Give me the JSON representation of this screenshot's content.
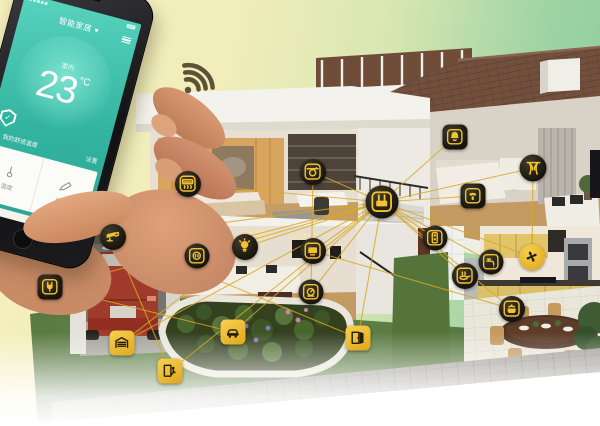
{
  "colors": {
    "accent": "#F2C230",
    "network_line": "#D9A81F",
    "screen_teal": "#35B7A3"
  },
  "phone": {
    "title": "智能家居",
    "caret": "▾",
    "room_label": "室内",
    "temp_value": "23",
    "temp_unit": "°C",
    "shield_check": "✓",
    "comfort_label": "我的舒适温度",
    "settings_label": "设置",
    "card_temp_label": "温度",
    "card_edit_label": "编辑",
    "card2_text": "A"
  },
  "icons": [
    {
      "id": "gateway-hub",
      "glyph": "hub",
      "style": "dark-circle",
      "x": 382,
      "y": 202,
      "size": 33
    },
    {
      "id": "security-camera",
      "glyph": "camera",
      "style": "dark-circle",
      "x": 113,
      "y": 237,
      "size": 26
    },
    {
      "id": "smart-plug",
      "glyph": "plug",
      "style": "dark-square",
      "x": 50,
      "y": 287,
      "size": 25
    },
    {
      "id": "wall-socket",
      "glyph": "socket",
      "style": "dark-circle",
      "x": 197,
      "y": 256,
      "size": 25
    },
    {
      "id": "light-bulb",
      "glyph": "bulb",
      "style": "dark-circle",
      "x": 245,
      "y": 247,
      "size": 26
    },
    {
      "id": "smart-tv",
      "glyph": "tv",
      "style": "dark-circle",
      "x": 313,
      "y": 251,
      "size": 26
    },
    {
      "id": "energy-meter",
      "glyph": "meter",
      "style": "dark-circle",
      "x": 311,
      "y": 292,
      "size": 25
    },
    {
      "id": "garage-door",
      "glyph": "garage",
      "style": "solid-square",
      "x": 122,
      "y": 343,
      "size": 25
    },
    {
      "id": "door-access",
      "glyph": "dooraccess",
      "style": "solid-square",
      "x": 170,
      "y": 371,
      "size": 25
    },
    {
      "id": "smart-car",
      "glyph": "car",
      "style": "solid-square",
      "x": 233,
      "y": 332,
      "size": 25
    },
    {
      "id": "door-sensor",
      "glyph": "doorsensor",
      "style": "solid-square",
      "x": 358,
      "y": 338,
      "size": 25
    },
    {
      "id": "air-conditioner",
      "glyph": "ac",
      "style": "dark-circle",
      "x": 188,
      "y": 184,
      "size": 26
    },
    {
      "id": "washing-machine",
      "glyph": "washer",
      "style": "dark-circle",
      "x": 313,
      "y": 172,
      "size": 26
    },
    {
      "id": "alarm-bell",
      "glyph": "bell",
      "style": "dark-square",
      "x": 455,
      "y": 137,
      "size": 25
    },
    {
      "id": "smart-curtain",
      "glyph": "curtain",
      "style": "dark-circle",
      "x": 533,
      "y": 168,
      "size": 27
    },
    {
      "id": "intercom",
      "glyph": "intercom",
      "style": "dark-square",
      "x": 473,
      "y": 196,
      "size": 25
    },
    {
      "id": "light-switch",
      "glyph": "switch",
      "style": "dark-circle",
      "x": 435,
      "y": 238,
      "size": 25
    },
    {
      "id": "water-faucet",
      "glyph": "faucet",
      "style": "dark-circle",
      "x": 491,
      "y": 262,
      "size": 25
    },
    {
      "id": "exhaust-fan",
      "glyph": "fan",
      "style": "solid-circle",
      "x": 532,
      "y": 257,
      "size": 26
    },
    {
      "id": "cooktop",
      "glyph": "pan",
      "style": "dark-circle",
      "x": 465,
      "y": 276,
      "size": 26
    },
    {
      "id": "rice-cooker",
      "glyph": "pot",
      "style": "dark-circle",
      "x": 512,
      "y": 309,
      "size": 26
    }
  ],
  "connections": [
    [
      "gateway-hub",
      "security-camera"
    ],
    [
      "gateway-hub",
      "smart-plug"
    ],
    [
      "gateway-hub",
      "wall-socket"
    ],
    [
      "gateway-hub",
      "light-bulb"
    ],
    [
      "gateway-hub",
      "smart-tv"
    ],
    [
      "gateway-hub",
      "energy-meter"
    ],
    [
      "gateway-hub",
      "garage-door"
    ],
    [
      "gateway-hub",
      "door-access"
    ],
    [
      "gateway-hub",
      "smart-car"
    ],
    [
      "gateway-hub",
      "door-sensor"
    ],
    [
      "gateway-hub",
      "air-conditioner"
    ],
    [
      "gateway-hub",
      "washing-machine"
    ],
    [
      "gateway-hub",
      "alarm-bell"
    ],
    [
      "gateway-hub",
      "smart-curtain"
    ],
    [
      "gateway-hub",
      "intercom"
    ],
    [
      "gateway-hub",
      "light-switch"
    ],
    [
      "gateway-hub",
      "water-faucet"
    ],
    [
      "gateway-hub",
      "exhaust-fan"
    ],
    [
      "gateway-hub",
      "cooktop"
    ],
    [
      "gateway-hub",
      "rice-cooker"
    ],
    [
      "security-camera",
      "door-sensor"
    ],
    [
      "smart-plug",
      "smart-car"
    ],
    [
      "light-bulb",
      "garage-door"
    ],
    [
      "smart-tv",
      "rice-cooker"
    ],
    [
      "smart-curtain",
      "exhaust-fan"
    ],
    [
      "air-conditioner",
      "wall-socket"
    ],
    [
      "washing-machine",
      "energy-meter"
    ],
    [
      "security-camera",
      "door-access"
    ]
  ]
}
